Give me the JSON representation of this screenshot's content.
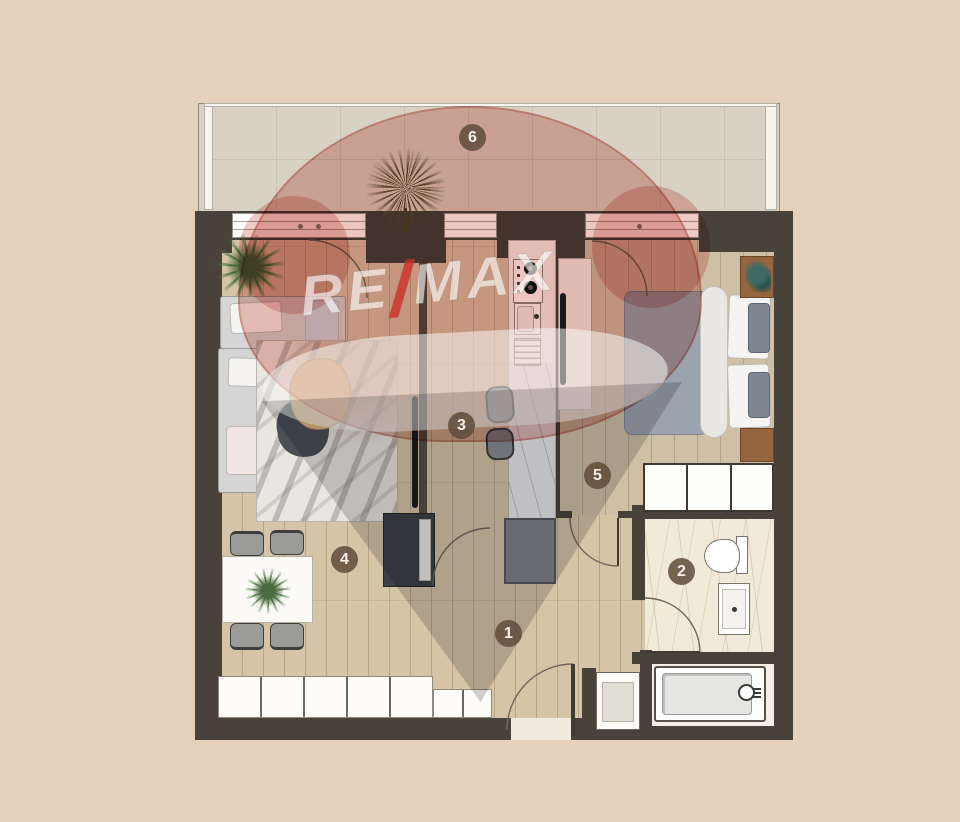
{
  "watermark": {
    "re": "RE",
    "slash": "/",
    "max": "MAX",
    "balloon_pink": "#dd938c",
    "balloon_gray": "#7d7f82",
    "slash_red": "#ce3026"
  },
  "rooms": {
    "hallway": {
      "number": "1"
    },
    "bathroom": {
      "number": "2"
    },
    "kitchen": {
      "number": "3"
    },
    "living": {
      "number": "4"
    },
    "bedroom": {
      "number": "5"
    },
    "balcony": {
      "number": "6"
    }
  },
  "colors": {
    "background": "#e6d1bd",
    "wall": "#49423a",
    "wood_floor": "#d6c4a7",
    "bedroom_floor": "#cfc0a5",
    "balcony_tile": "#d9d2c4",
    "bathroom_marble": "#f2ead9",
    "number_badge": "#5f4b39"
  }
}
